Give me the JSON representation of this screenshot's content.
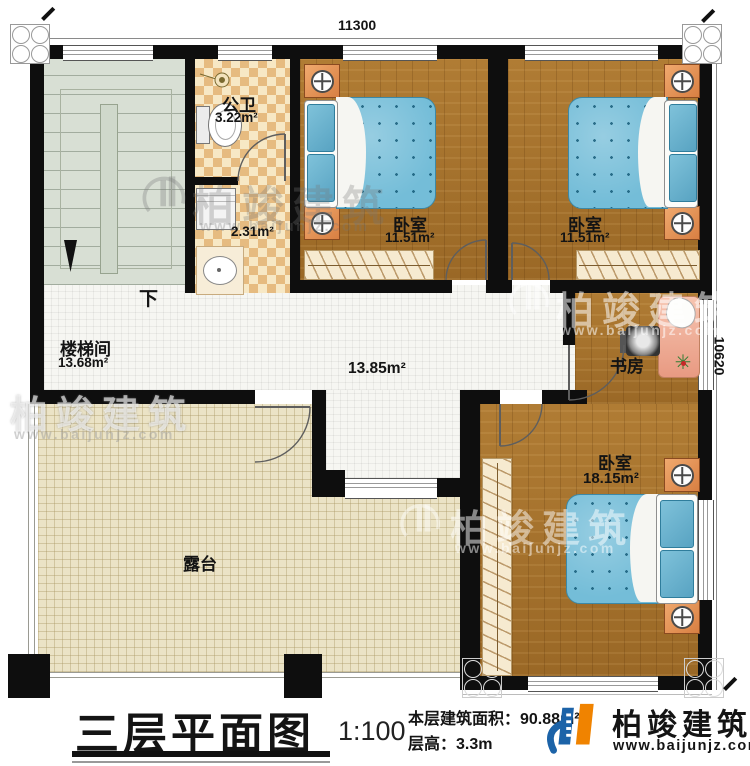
{
  "dimensions": {
    "top": "11300",
    "right": "10620"
  },
  "rooms": {
    "stairwell": {
      "name": "楼梯间",
      "area": "13.68m²",
      "direction": "下"
    },
    "bathroom": {
      "name": "公卫",
      "area": "3.22m²"
    },
    "laundry": {
      "area": "2.31m²"
    },
    "bedroom1": {
      "name": "卧室",
      "area": "11.51m²"
    },
    "bedroom2": {
      "name": "卧室",
      "area": "11.51m²"
    },
    "hall": {
      "area": "13.85m²"
    },
    "study": {
      "name": "书房"
    },
    "bedroom3": {
      "name": "卧室",
      "area": "18.15m²"
    },
    "terrace": {
      "name": "露台"
    }
  },
  "title_block": {
    "title": "三层平面图",
    "scale": "1:100",
    "floor_area": "本层建筑面积：90.88m²",
    "floor_height": "层高：3.3m"
  },
  "brand": {
    "name": "柏竣建筑",
    "website": "www.baijunjz.com"
  },
  "watermark": {
    "name": "柏竣建筑",
    "website": "www.baijunjz.com"
  },
  "colors": {
    "wood": "#a9752e",
    "mattress_blue": "#74bdd8",
    "nightstand_orange": "#e0854e",
    "terrace": "#ebe3c6",
    "brand_blue": "#1c63a8",
    "brand_orange": "#f08300"
  }
}
